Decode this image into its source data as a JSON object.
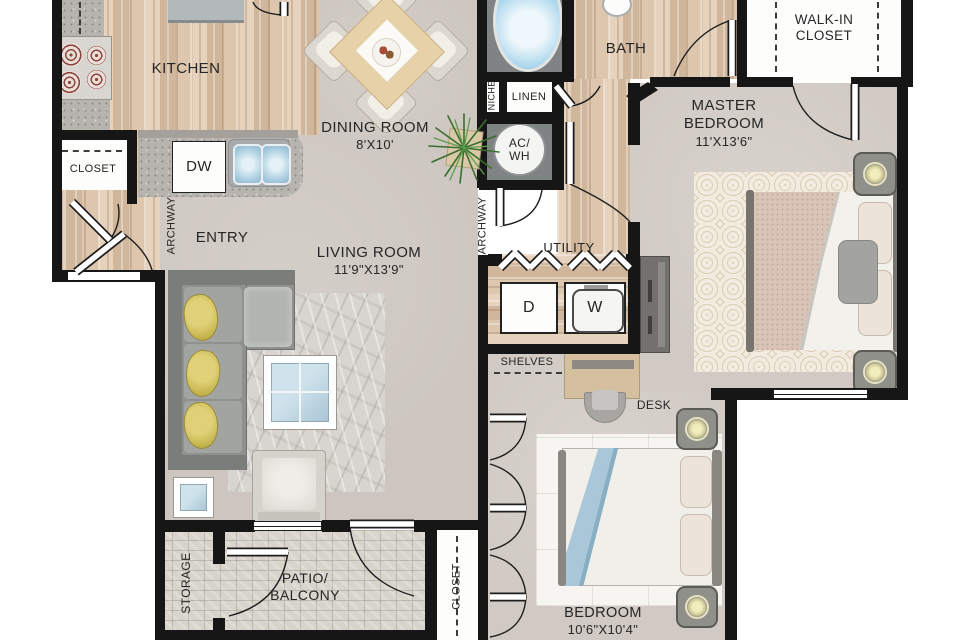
{
  "title": "Apartment Floor Plan",
  "labels": {
    "kitchen": "KITCHEN",
    "dining_room": "DINING ROOM",
    "dining_dims": "8'X10'",
    "bath": "BATH",
    "walk_in_closet": "WALK-IN CLOSET",
    "master_bedroom": "MASTER BEDROOM",
    "master_dims": "11'X13'6\"",
    "entry": "ENTRY",
    "living_room": "LIVING ROOM",
    "living_dims": "11'9\"X13'9\"",
    "utility": "UTILITY",
    "bedroom": "BEDROOM",
    "bedroom_dims": "10'6\"X10'4\"",
    "patio": "PATIO/ BALCONY",
    "storage": "STORAGE",
    "entry_closet": "CLOSET",
    "patio_closet": "CLOSET",
    "niche": "NICHE",
    "linen": "LINEN",
    "ac_wh": "AC/ WH",
    "shelves": "SHELVES",
    "desk": "DESK",
    "archway_left": "ARCHWAY",
    "archway_right": "ARCHWAY",
    "dishwasher": "DW",
    "dryer": "D",
    "washer": "W"
  },
  "colors": {
    "wall": "#161616",
    "wood": "#d9c5ae",
    "carpet": "#cdc6c0",
    "patio_brick": "#d7d4cb",
    "granite": "#b7b4af",
    "tub_water": "#8cc4e4",
    "pillow_yellow": "#d3c162",
    "plant_green": "#4a8039"
  }
}
